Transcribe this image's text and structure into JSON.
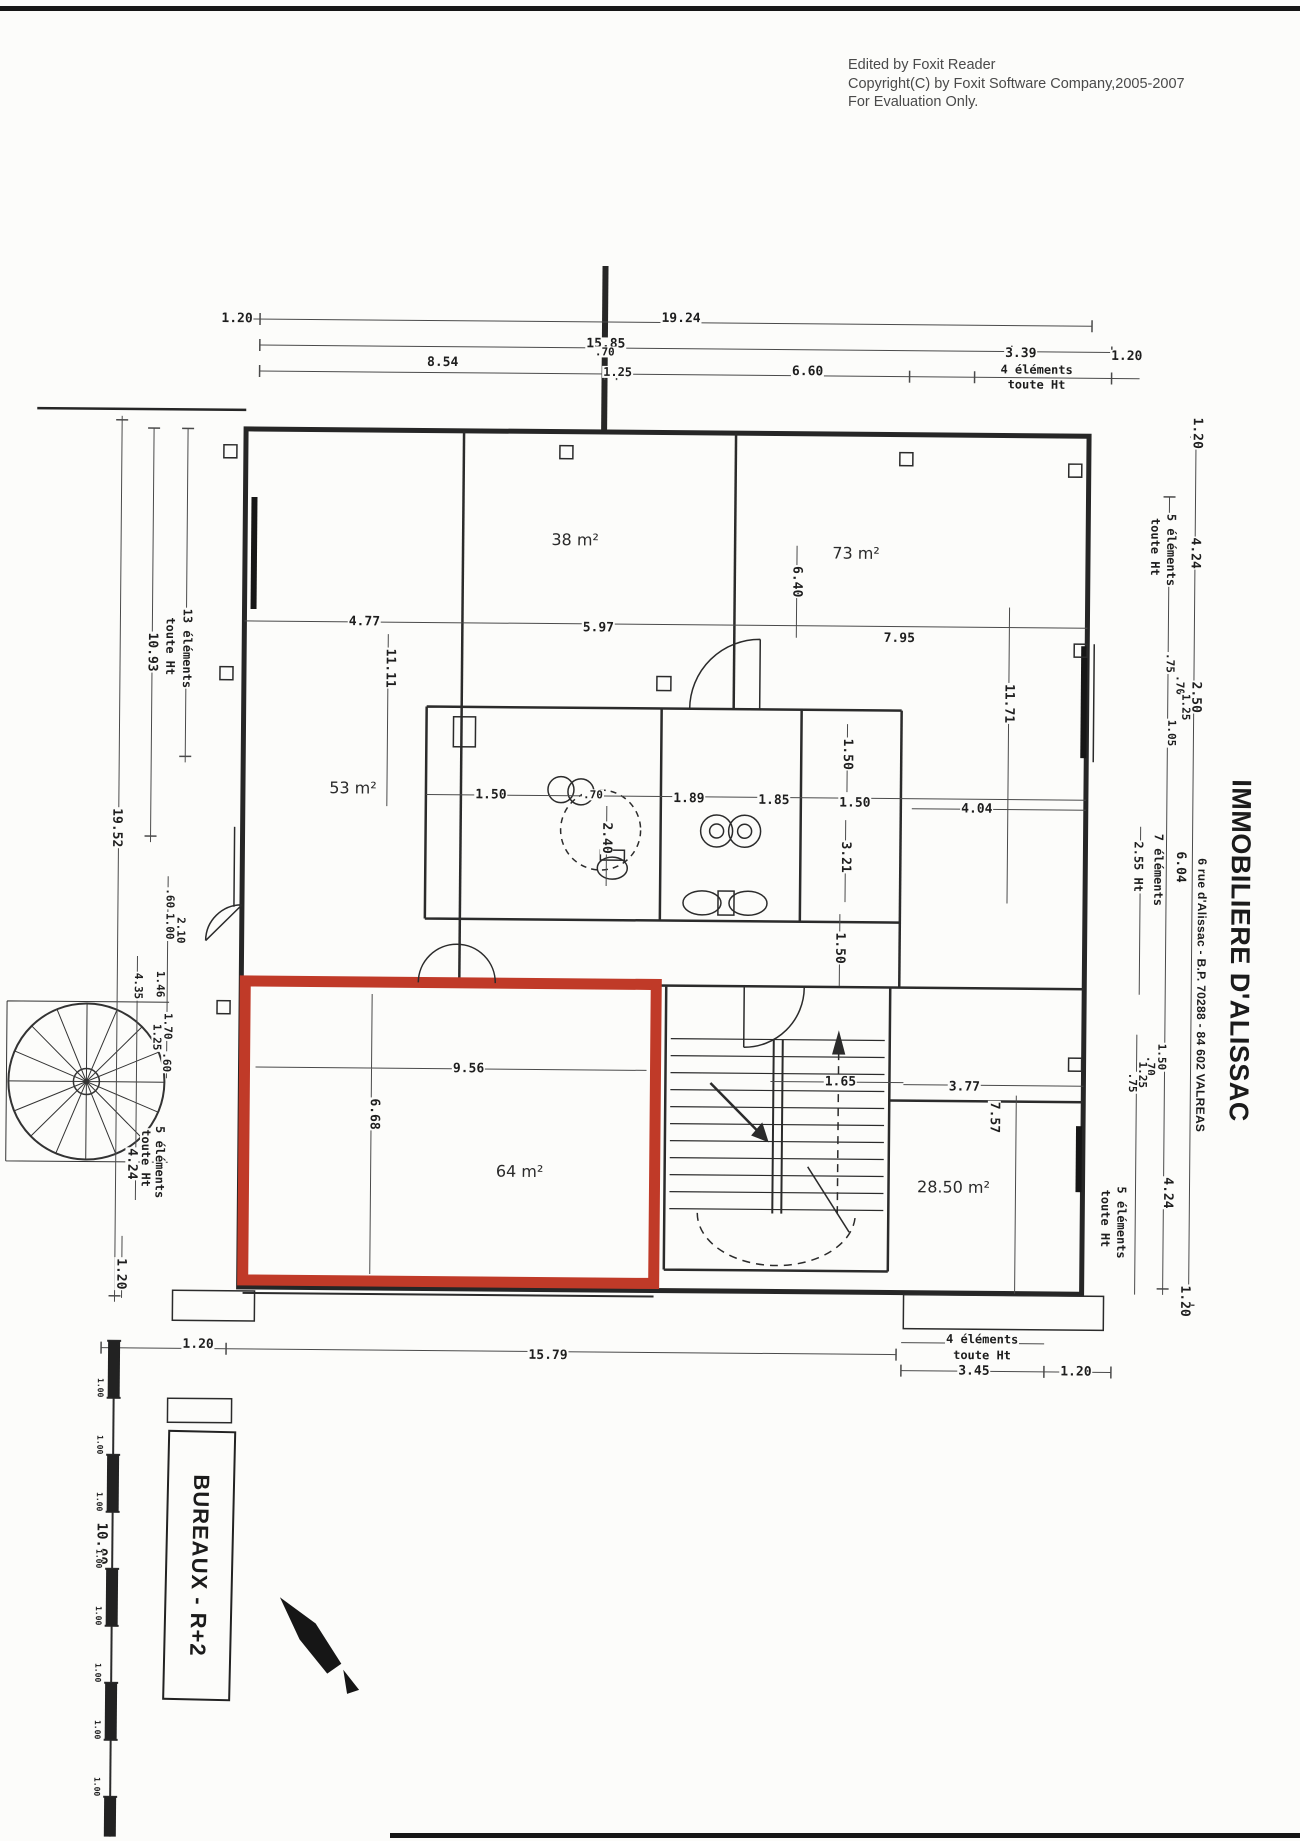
{
  "notice": [
    "Edited by Foxit Reader",
    "Copyright(C) by Foxit Software Company,2005-2007",
    "For Evaluation Only."
  ],
  "title_block": {
    "company": "IMMOBILIERE D'ALISSAC",
    "address": "6 rue d'Alissac - B.P. 70288 - 84 602 VALREAS",
    "plan_label": "BUREAUX - R+2"
  },
  "colors": {
    "highlight_red": "#c03a28",
    "ink": "#262626",
    "notice_gray": "#4a4a4a"
  },
  "rooms": [
    {
      "label": "38 m²",
      "x": 572,
      "y": 540
    },
    {
      "label": "73 m²",
      "x": 853,
      "y": 551
    },
    {
      "label": "53 m²",
      "x": 352,
      "y": 790
    },
    {
      "label": "64 m²",
      "x": 522,
      "y": 1172
    },
    {
      "label": "28.50 m²",
      "x": 956,
      "y": 1184
    }
  ],
  "scale_bar": {
    "unit_label": "1.00",
    "total_label": "10.00",
    "segments": 8
  },
  "annotations": [
    {
      "t": "1.20",
      "x": 232,
      "y": 322
    },
    {
      "t": "19.24",
      "x": 676,
      "y": 318
    },
    {
      "t": "15.85",
      "x": 601,
      "y": 344
    },
    {
      "t": "8.54",
      "x": 438,
      "y": 364
    },
    {
      "t": ".70",
      "x": 600,
      "y": 352,
      "s": 11
    },
    {
      "t": "1.25",
      "x": 613,
      "y": 372,
      "s": 12
    },
    {
      "t": "6.60",
      "x": 803,
      "y": 370
    },
    {
      "t": "3.39",
      "x": 1016,
      "y": 350
    },
    {
      "t": "4 éléments",
      "x": 1032,
      "y": 366,
      "s": 12
    },
    {
      "t": "toute Ht",
      "x": 1032,
      "y": 381,
      "s": 12
    },
    {
      "t": "1.20",
      "x": 1122,
      "y": 352
    },
    {
      "t": "1.20",
      "x": 1193,
      "y": 428,
      "r": 90
    },
    {
      "t": "5 éléments",
      "x": 1168,
      "y": 545,
      "r": 90,
      "s": 12
    },
    {
      "t": "toute Ht",
      "x": 1152,
      "y": 542,
      "r": 90,
      "s": 12
    },
    {
      "t": "4.24",
      "x": 1192,
      "y": 548,
      "r": 90
    },
    {
      "t": "2.50",
      "x": 1194,
      "y": 692,
      "r": 90
    },
    {
      "t": ".75",
      "x": 1168,
      "y": 658,
      "r": 90,
      "s": 11
    },
    {
      "t": ".70",
      "x": 1178,
      "y": 680,
      "r": 90,
      "s": 11
    },
    {
      "t": "1.25",
      "x": 1184,
      "y": 702,
      "r": 90,
      "s": 11
    },
    {
      "t": "1.05",
      "x": 1170,
      "y": 728,
      "r": 90,
      "s": 11
    },
    {
      "t": "6.04",
      "x": 1180,
      "y": 862,
      "r": 90
    },
    {
      "t": "7 éléments",
      "x": 1158,
      "y": 865,
      "r": 90,
      "s": 12
    },
    {
      "t": "2.55 Ht",
      "x": 1138,
      "y": 862,
      "r": 90,
      "s": 12
    },
    {
      "t": "1.50",
      "x": 1163,
      "y": 1052,
      "r": 90,
      "s": 11
    },
    {
      "t": ".70",
      "x": 1152,
      "y": 1061,
      "r": 90,
      "s": 11
    },
    {
      "t": "1.25",
      "x": 1144,
      "y": 1070,
      "r": 90,
      "s": 11
    },
    {
      "t": ".75",
      "x": 1134,
      "y": 1078,
      "r": 90,
      "s": 11
    },
    {
      "t": "4.24",
      "x": 1170,
      "y": 1188,
      "r": 90
    },
    {
      "t": "5 éléments",
      "x": 1124,
      "y": 1218,
      "r": 90,
      "s": 12
    },
    {
      "t": "toute Ht",
      "x": 1108,
      "y": 1214,
      "r": 90,
      "s": 12
    },
    {
      "t": "1.20",
      "x": 1188,
      "y": 1296,
      "r": 90
    },
    {
      "t": "13 éléments",
      "x": 185,
      "y": 652,
      "r": 90,
      "s": 12
    },
    {
      "t": "toute Ht",
      "x": 168,
      "y": 650,
      "r": 90,
      "s": 12
    },
    {
      "t": "10.93",
      "x": 150,
      "y": 656,
      "r": 90
    },
    {
      "t": "19.52",
      "x": 116,
      "y": 832,
      "r": 90
    },
    {
      "t": ".60",
      "x": 170,
      "y": 902,
      "r": 90,
      "s": 11
    },
    {
      "t": "1.00",
      "x": 170,
      "y": 930,
      "r": 90,
      "s": 11
    },
    {
      "t": "2.10",
      "x": 181,
      "y": 934,
      "r": 90,
      "s": 11
    },
    {
      "t": "1.46",
      "x": 161,
      "y": 988,
      "r": 90,
      "s": 11
    },
    {
      "t": "4.35",
      "x": 139,
      "y": 990,
      "r": 90,
      "s": 11
    },
    {
      "t": "1.70",
      "x": 169,
      "y": 1030,
      "r": 90,
      "s": 11
    },
    {
      "t": "1.25",
      "x": 158,
      "y": 1041,
      "r": 90,
      "s": 11
    },
    {
      "t": ".60",
      "x": 168,
      "y": 1066,
      "r": 90,
      "s": 11
    },
    {
      "t": "5 éléments",
      "x": 162,
      "y": 1166,
      "r": 90,
      "s": 12
    },
    {
      "t": "toute Ht",
      "x": 148,
      "y": 1162,
      "r": 90,
      "s": 12
    },
    {
      "t": "4.24",
      "x": 134,
      "y": 1168,
      "r": 90
    },
    {
      "t": "1.20",
      "x": 124,
      "y": 1278,
      "r": 90
    },
    {
      "t": "4.77",
      "x": 362,
      "y": 624
    },
    {
      "t": "5.97",
      "x": 596,
      "y": 628
    },
    {
      "t": "7.95",
      "x": 897,
      "y": 636
    },
    {
      "t": "11.11",
      "x": 388,
      "y": 670,
      "r": 90
    },
    {
      "t": "6.40",
      "x": 794,
      "y": 580,
      "r": 90
    },
    {
      "t": "11.71",
      "x": 1007,
      "y": 700,
      "r": 90
    },
    {
      "t": "1.50",
      "x": 490,
      "y": 796
    },
    {
      "t": ".70",
      "x": 592,
      "y": 795,
      "s": 11
    },
    {
      "t": "2.40",
      "x": 606,
      "y": 838,
      "r": 90
    },
    {
      "t": "1.89",
      "x": 688,
      "y": 798
    },
    {
      "t": "1.85",
      "x": 773,
      "y": 799
    },
    {
      "t": "1.50",
      "x": 854,
      "y": 801
    },
    {
      "t": "3.21",
      "x": 845,
      "y": 855,
      "r": 90
    },
    {
      "t": "4.04",
      "x": 976,
      "y": 806
    },
    {
      "t": "1.50",
      "x": 846,
      "y": 752,
      "r": 90
    },
    {
      "t": "1.50",
      "x": 840,
      "y": 946,
      "r": 90
    },
    {
      "t": "9.56",
      "x": 470,
      "y": 1070
    },
    {
      "t": "6.68",
      "x": 376,
      "y": 1116,
      "r": 90
    },
    {
      "t": "1.65",
      "x": 842,
      "y": 1080
    },
    {
      "t": "3.77",
      "x": 966,
      "y": 1084
    },
    {
      "t": "7.57",
      "x": 996,
      "y": 1114,
      "r": 90
    },
    {
      "t": "1.20",
      "x": 202,
      "y": 1348
    },
    {
      "t": "15.79",
      "x": 552,
      "y": 1356
    },
    {
      "t": "4 éléments",
      "x": 986,
      "y": 1336,
      "s": 12
    },
    {
      "t": "toute Ht",
      "x": 986,
      "y": 1352,
      "s": 12
    },
    {
      "t": "3.45",
      "x": 978,
      "y": 1368
    },
    {
      "t": "1.20",
      "x": 1080,
      "y": 1368
    },
    {
      "t": "10.00",
      "x": 107,
      "y": 1548,
      "r": 90,
      "s": 14
    }
  ]
}
